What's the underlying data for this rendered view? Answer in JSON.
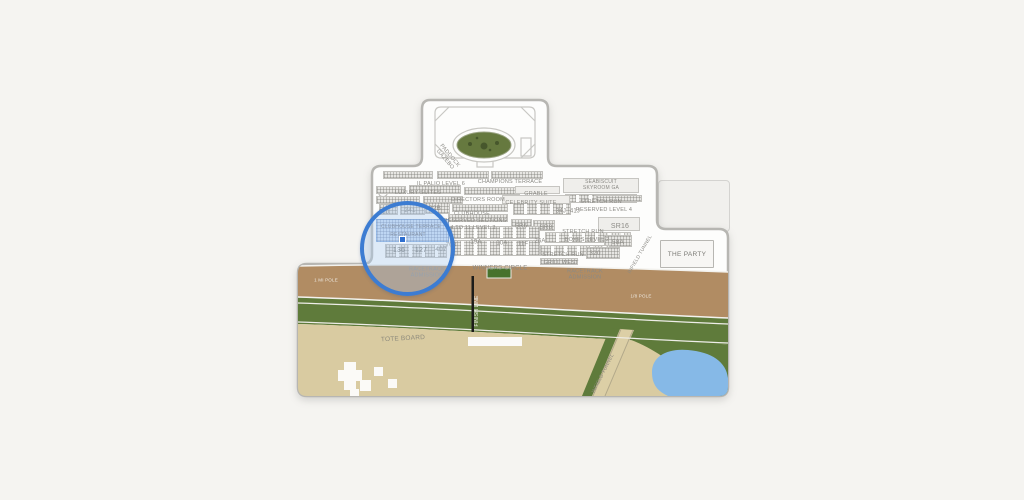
{
  "title": "Racetrack venue seating map",
  "colors": {
    "background": "#f5f4f1",
    "map_fill": "#fdfdfc",
    "outline": "#b7b6b2",
    "label": "#8b8a85",
    "dirt_track": "#b18c63",
    "turf": "#5f7b3b",
    "infield": "#d9cba1",
    "pond": "#86b9e7",
    "paddock_green": "#66793f",
    "winners_green": "#47722c",
    "road": "#dccfa6",
    "highlight_ring": "#3c7cd2",
    "highlight_fill": "rgba(170,202,240,0.38)",
    "marker_blue": "#2e6fd0"
  },
  "map": {
    "party_label": "THE PARTY",
    "highlighted_section": "CLUBHOUSE TERRACE RESTAURANT",
    "labels": [
      {
        "id": "paddock-gazebo",
        "text": "PADDOCK\nGAZEBO",
        "x": 447,
        "y": 158,
        "r": 50,
        "s": 5.5
      },
      {
        "id": "il-palio-level-6",
        "text": "IL PALIO LEVEL 6",
        "x": 441,
        "y": 184
      },
      {
        "id": "champions-terrace",
        "text": "CHAMPIONS TERRACE",
        "x": 510,
        "y": 182
      },
      {
        "id": "seabiscuit-skyroom",
        "text": "SEABISCUIT\nSKYROOM GA",
        "x": 601,
        "y": 186,
        "s": 5
      },
      {
        "id": "luxury-suites",
        "text": "LUXURY SUITES",
        "x": 418,
        "y": 193
      },
      {
        "id": "grable",
        "text": "GRABLE",
        "x": 536,
        "y": 194
      },
      {
        "id": "directors-room",
        "text": "DIRECTORS ROOM",
        "x": 478,
        "y": 200
      },
      {
        "id": "celebrity-suite",
        "text": "CELEBRITY SUITE",
        "x": 531,
        "y": 203
      },
      {
        "id": "stretch-run-upper",
        "text": "STRETCH RUN",
        "x": 601,
        "y": 202
      },
      {
        "id": "reserved-level-4",
        "text": "RESERVED LEVEL 4",
        "x": 604,
        "y": 210
      },
      {
        "id": "sec-160",
        "text": "160",
        "x": 384,
        "y": 213,
        "s": 6
      },
      {
        "id": "sec-241",
        "text": "241",
        "x": 410,
        "y": 211,
        "s": 6.5
      },
      {
        "id": "sec-22b",
        "text": "22B",
        "x": 435,
        "y": 209,
        "s": 6.5
      },
      {
        "id": "clubhouse",
        "text": "CLUBHOUSE",
        "x": 472,
        "y": 214
      },
      {
        "id": "sec-34j",
        "text": "34J",
        "x": 561,
        "y": 212,
        "s": 6
      },
      {
        "id": "sec-41j",
        "text": "41J",
        "x": 575,
        "y": 212,
        "s": 6
      },
      {
        "id": "reserved-sections",
        "text": "RESERVED SECTIONS",
        "x": 475,
        "y": 221
      },
      {
        "id": "four-to-11-level-3",
        "text": "4 TO 11 LEVEL 3",
        "x": 473,
        "y": 228
      },
      {
        "id": "sec-sr6",
        "text": "SR6",
        "x": 521,
        "y": 227,
        "s": 6
      },
      {
        "id": "sec-sr8",
        "text": "SR8",
        "x": 546,
        "y": 228,
        "s": 6.5
      },
      {
        "id": "sec-sr16",
        "text": "SR16",
        "x": 620,
        "y": 227,
        "s": 7
      },
      {
        "id": "stretch-run-mid",
        "text": "STRETCH RUN",
        "x": 583,
        "y": 232
      },
      {
        "id": "boxes-level-2",
        "text": "BOXES LEVEL 2",
        "x": 587,
        "y": 240
      },
      {
        "id": "clubhouse-terrace",
        "text": "CLUBHOUSE TERRACE",
        "x": 411,
        "y": 228,
        "s": 5,
        "c": "#73767e"
      },
      {
        "id": "restaurant",
        "text": "RESTAURANT",
        "x": 408,
        "y": 236,
        "s": 5,
        "c": "#73767e"
      },
      {
        "id": "sec-703",
        "text": "703",
        "x": 451,
        "y": 246,
        "s": 6
      },
      {
        "id": "sec-19a",
        "text": "19A",
        "x": 476,
        "y": 243,
        "s": 6
      },
      {
        "id": "sec-10a",
        "text": "10A",
        "x": 502,
        "y": 244,
        "s": 6
      },
      {
        "id": "sec-11f",
        "text": "11F",
        "x": 523,
        "y": 245,
        "s": 6
      },
      {
        "id": "sec-26a",
        "text": "26A",
        "x": 540,
        "y": 242,
        "s": 6
      },
      {
        "id": "sec-58a",
        "text": "58A",
        "x": 618,
        "y": 243,
        "s": 6.5
      },
      {
        "id": "sec-136",
        "text": "136",
        "x": 399,
        "y": 251,
        "s": 7,
        "c": "#6f6e69"
      },
      {
        "id": "sec-127",
        "text": "127",
        "x": 421,
        "y": 251,
        "s": 7,
        "c": "#6f6e69"
      },
      {
        "id": "sec-407",
        "text": "407",
        "x": 441,
        "y": 250,
        "s": 6.5
      },
      {
        "id": "sec-320",
        "text": "320",
        "x": 595,
        "y": 254,
        "s": 6.5
      },
      {
        "id": "stretch-run-lower",
        "text": "STRETCH RUN",
        "x": 563,
        "y": 255
      },
      {
        "id": "grill-west",
        "text": "GRILL WEST",
        "x": 561,
        "y": 263
      },
      {
        "id": "infield-tunnel-upper",
        "text": "INFIELD TUNNEL",
        "x": 641,
        "y": 255,
        "r": -60,
        "s": 5
      },
      {
        "id": "infield-tunnel-lower",
        "text": "INFIELD TUNNEL",
        "x": 604,
        "y": 374,
        "r": -63,
        "s": 5,
        "c": "#8f8c80"
      },
      {
        "id": "racetrack-admission-left",
        "text": "RACETRACK\nADMISSION",
        "x": 427,
        "y": 273
      },
      {
        "id": "racetrack-admission-right",
        "text": "RACETRACK\nADMISSION",
        "x": 585,
        "y": 275
      },
      {
        "id": "winners-circle",
        "text": "WINNERS CIRCLE",
        "x": 500,
        "y": 269,
        "s": 6
      },
      {
        "id": "finish-line",
        "text": "FINISH LINE",
        "x": 478,
        "y": 311,
        "r": -90,
        "s": 5,
        "c": "#f2f2ec"
      },
      {
        "id": "tote-board",
        "text": "TOTE BOARD",
        "x": 403,
        "y": 339,
        "s": 6.5,
        "r": -3,
        "c": "#8d8a7c"
      },
      {
        "id": "pole-marker-left",
        "text": "1 MI POLE",
        "x": 326,
        "y": 280,
        "s": 4.5,
        "c": "#efeae2"
      },
      {
        "id": "pole-marker-right",
        "text": "1/8 POLE",
        "x": 641,
        "y": 296,
        "s": 4.5,
        "c": "#efeae2"
      }
    ]
  }
}
